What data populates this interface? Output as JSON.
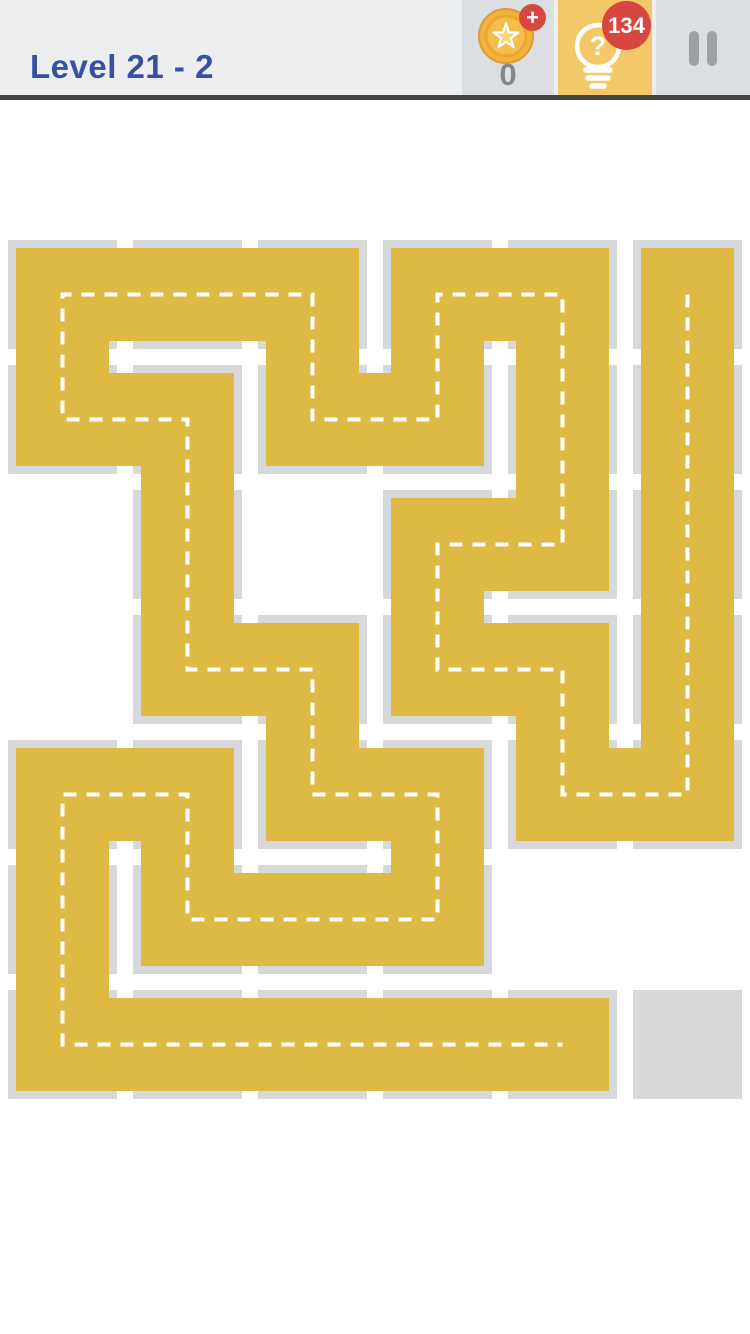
{
  "header": {
    "title": "Level 21 - 2",
    "title_color": "#3851a0",
    "background": "#eceef0",
    "divider_color": "#454648",
    "coin_button": {
      "count": "0",
      "plus_badge": "+",
      "badge_color": "#d7473f",
      "coin_gold": "#f2b23d",
      "coin_ring": "#dd9c2e",
      "background": "#dcdfe1"
    },
    "hint_button": {
      "badge": "134",
      "badge_color": "#d7473f",
      "icon_glyph": "?",
      "background": "#f2c868",
      "icon_color": "#ffffff"
    },
    "pause_button": {
      "bar_color": "#9aa0a6",
      "background": "#dcdfe1"
    }
  },
  "board": {
    "cols": 6,
    "rows": 7,
    "legend": "Y = filled path cell, G = empty board cell, - = no cell",
    "cells": [
      "YYYYYY",
      "YYYYYY",
      "-Y-YYY",
      "-YYYYY",
      "YYYYYY",
      "YYYY--",
      "YYYYYG"
    ],
    "path": [
      [
        5,
        0
      ],
      [
        5,
        1
      ],
      [
        5,
        2
      ],
      [
        5,
        3
      ],
      [
        5,
        4
      ],
      [
        4,
        4
      ],
      [
        4,
        3
      ],
      [
        3,
        3
      ],
      [
        3,
        2
      ],
      [
        4,
        2
      ],
      [
        4,
        1
      ],
      [
        4,
        0
      ],
      [
        3,
        0
      ],
      [
        3,
        1
      ],
      [
        2,
        1
      ],
      [
        2,
        0
      ],
      [
        1,
        0
      ],
      [
        0,
        0
      ],
      [
        0,
        1
      ],
      [
        1,
        1
      ],
      [
        1,
        2
      ],
      [
        1,
        3
      ],
      [
        2,
        3
      ],
      [
        2,
        4
      ],
      [
        3,
        4
      ],
      [
        3,
        5
      ],
      [
        2,
        5
      ],
      [
        1,
        5
      ],
      [
        1,
        4
      ],
      [
        0,
        4
      ],
      [
        0,
        5
      ],
      [
        0,
        6
      ],
      [
        1,
        6
      ],
      [
        2,
        6
      ],
      [
        3,
        6
      ],
      [
        4,
        6
      ]
    ],
    "colors": {
      "filled": "#deba45",
      "empty_cell": "#d6d8da",
      "dash_line": "#ffffff"
    }
  }
}
